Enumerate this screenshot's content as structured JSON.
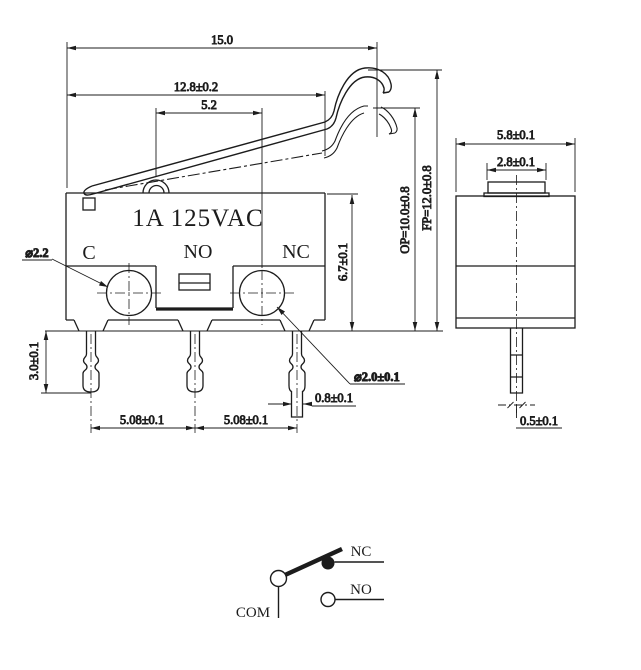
{
  "front": {
    "rating_label": "1A  125VAC",
    "terminals": {
      "common": "C",
      "normally_open": "NO",
      "normally_closed": "NC"
    },
    "dims": {
      "total_length": "15.0",
      "lever_length": "12.8±0.2",
      "button_offset": "5.2",
      "body_height": "6.7±0.1",
      "operating_position": "OP=10.0±0.8",
      "free_position": "FP=12.0±0.8",
      "pin_length": "3.0±0.1",
      "pin_pitch_left": "5.08±0.1",
      "pin_pitch_right": "5.08±0.1",
      "pin_width": "0.8±0.1",
      "hole_diameter_c": "⌀2.2",
      "hole_diameter_nc": "⌀2.0±0.1"
    }
  },
  "side": {
    "dims": {
      "body_depth": "5.8±0.1",
      "button_width": "2.8±0.1",
      "pin_thickness": "0.5±0.1"
    }
  },
  "schematic": {
    "common_label": "COM",
    "nc_label": "NC",
    "no_label": "NO"
  },
  "colors": {
    "line": "#1c1c1c",
    "background": "#ffffff"
  }
}
